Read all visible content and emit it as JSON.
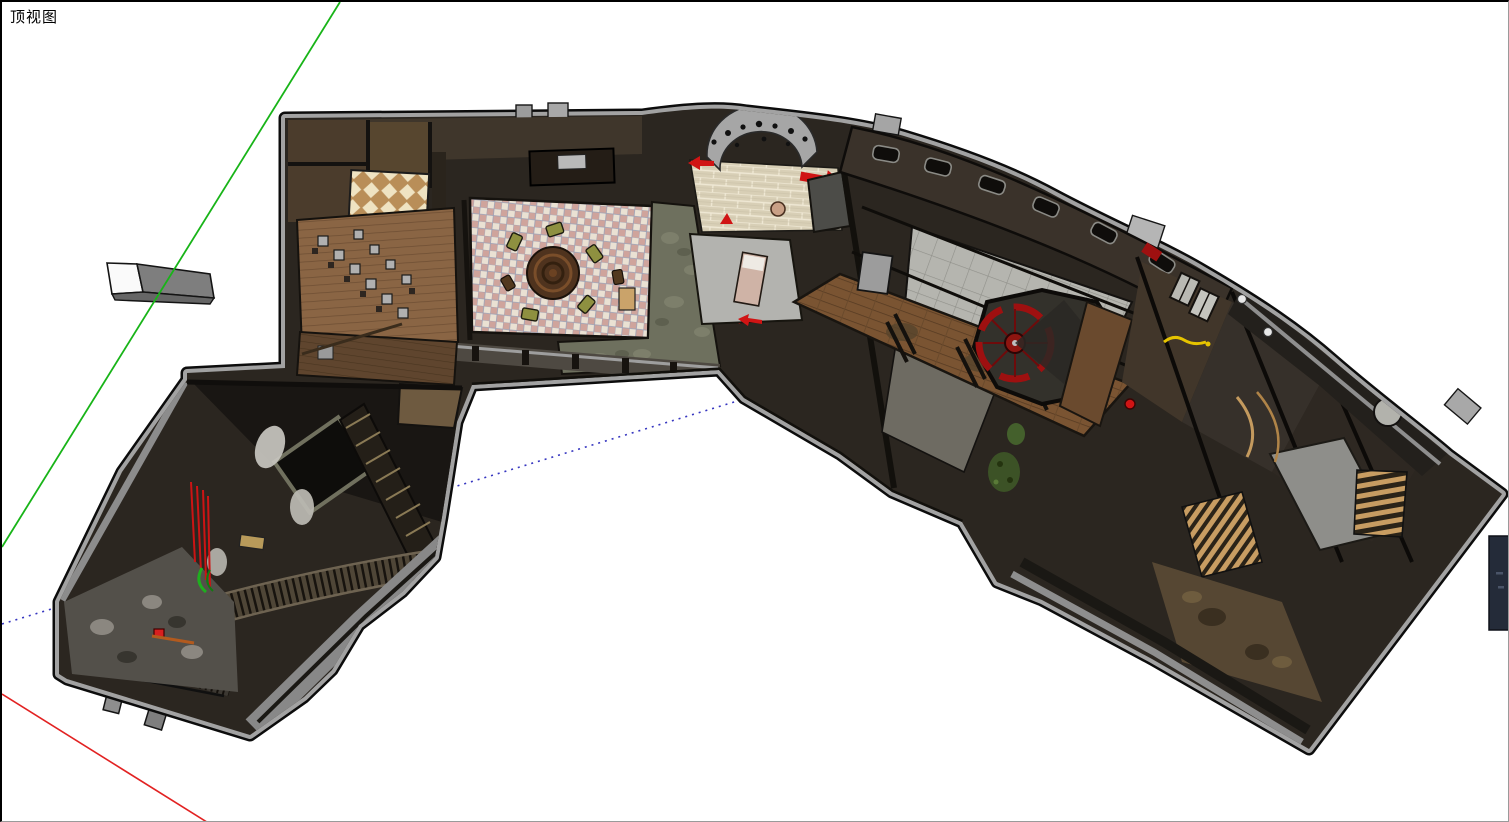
{
  "viewport": {
    "label": "顶视图",
    "width": 1509,
    "height": 822,
    "background": "#ffffff"
  },
  "axes": {
    "green": {
      "color": "#18b418",
      "x1": 338,
      "y1": 0,
      "x2": 0,
      "y2": 545
    },
    "red": {
      "color": "#e22222",
      "x1": 0,
      "y1": 692,
      "x2": 208,
      "y2": 822
    },
    "blue_dotted": {
      "color": "#3636c0",
      "x1": 0,
      "y1": 622,
      "x2": 742,
      "y2": 397,
      "dash": "2 5"
    }
  },
  "floating_box": {
    "face_light": "#fafafa",
    "face_dark": "#7e7e7e",
    "face_bottom": "#666666",
    "outline": "#141414"
  },
  "side_object": {
    "color": "#242b39",
    "outline": "#0e1118"
  },
  "model": {
    "outline_path": "M283,116 L640,113 C690,106 720,105 745,109 C810,116 862,122 902,134 C962,152 1012,171 1052,193 C1112,225 1162,245 1202,269 C1257,301 1297,328 1332,359 C1377,398 1422,431 1447,453 L1500,492 L1307,747 L1150,657 L1040,598 L995,580 L960,520 L890,490 L838,452 L742,396 L717,368 L470,383 L455,420 L440,515 L433,555 L400,590 L357,623 L330,668 L302,695 L248,733 L65,677 L57,672 L57,600 L120,470 L185,378 L185,371 L283,366 Z",
    "base_color": "#2b2620",
    "rim_color": "#a2a2a2",
    "outline_color": "#0c0c0c",
    "materials": {
      "dark_wall": "#3a322a",
      "wood_floor": "#8a6544",
      "wood_walkway": "#7a5432",
      "deck_wood": "#5f452e",
      "tile_checker_bg": "#eae1d3",
      "tile_checker_accent": "#cfa49c",
      "tile_cream": "#d8cfb6",
      "tile_gray": "#b5b5af",
      "stone_floor": "#6e705e",
      "slat_tan": "#c89d62",
      "dirt_floor": "#564733",
      "concrete": "#53504a",
      "lattice_tan": "#b98e58",
      "lattice_cream": "#efe3c2"
    },
    "accents": {
      "red": "#d01414",
      "dark_red": "#8e1510",
      "wheel_red": "#9e1010",
      "yellow": "#e6c400",
      "green_detail": "#1fae1f",
      "olive_chair": "#8e9040"
    }
  }
}
